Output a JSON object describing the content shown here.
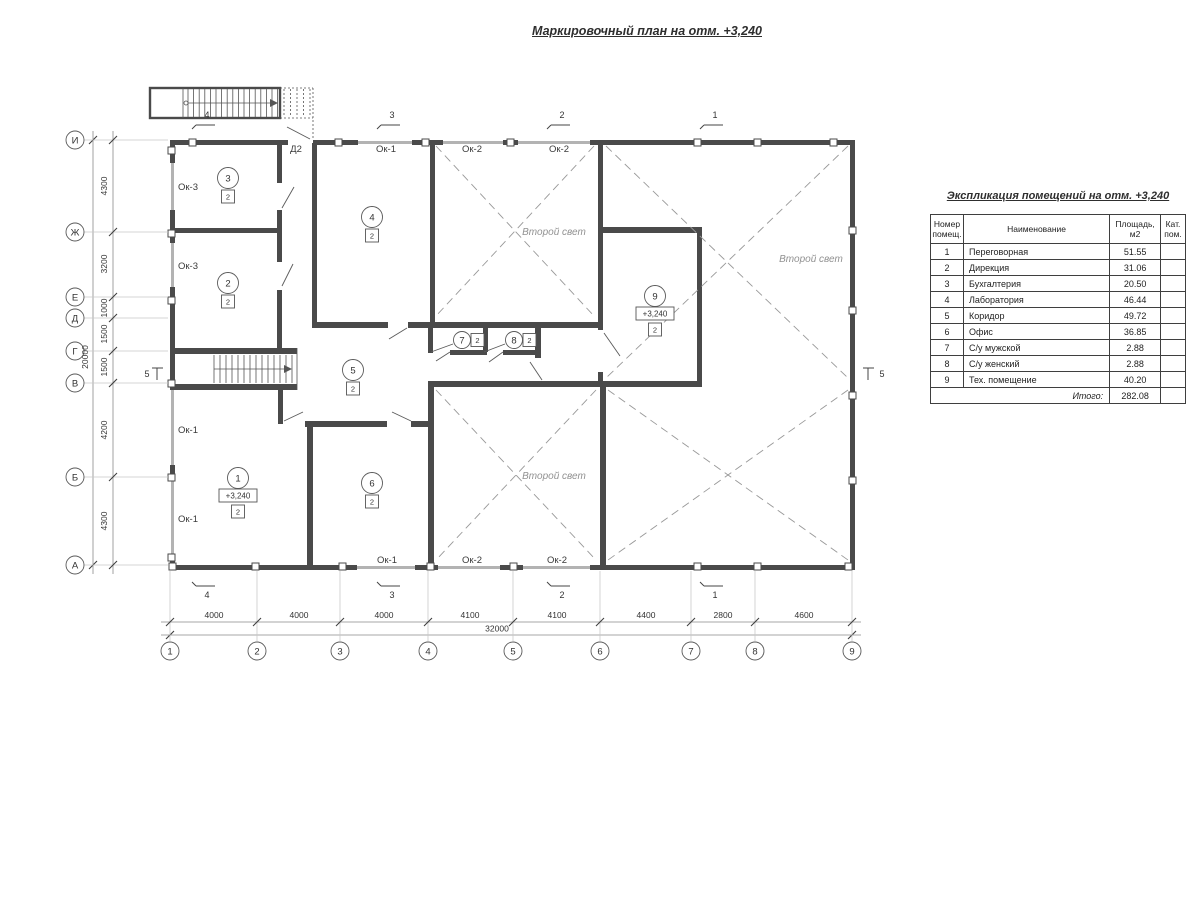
{
  "page_title": "Маркировочный план на отм. +3,240",
  "plan": {
    "elevation_mark": "+3,240",
    "axes_left": [
      {
        "label": "И",
        "y": 140
      },
      {
        "label": "Ж",
        "y": 232
      },
      {
        "label": "Е",
        "y": 297
      },
      {
        "label": "Д",
        "y": 318
      },
      {
        "label": "Г",
        "y": 351
      },
      {
        "label": "В",
        "y": 383
      },
      {
        "label": "Б",
        "y": 477
      },
      {
        "label": "А",
        "y": 565
      }
    ],
    "axes_bottom": [
      {
        "label": "1",
        "x": 170
      },
      {
        "label": "2",
        "x": 257
      },
      {
        "label": "3",
        "x": 340
      },
      {
        "label": "4",
        "x": 428
      },
      {
        "label": "5",
        "x": 513
      },
      {
        "label": "6",
        "x": 600
      },
      {
        "label": "7",
        "x": 691
      },
      {
        "label": "8",
        "x": 755
      },
      {
        "label": "9",
        "x": 852
      }
    ],
    "dims_left": [
      {
        "text": "4300",
        "y": 186
      },
      {
        "text": "3200",
        "y": 264
      },
      {
        "text": "1000",
        "y": 308
      },
      {
        "text": "1500",
        "y": 334
      },
      {
        "text": "1500",
        "y": 367
      },
      {
        "text": "4200",
        "y": 430
      },
      {
        "text": "4300",
        "y": 521
      }
    ],
    "dim_left_total": "20000",
    "dims_bottom": [
      {
        "text": "4000",
        "x": 214
      },
      {
        "text": "4000",
        "x": 299
      },
      {
        "text": "4000",
        "x": 384
      },
      {
        "text": "4100",
        "x": 470
      },
      {
        "text": "4100",
        "x": 557
      },
      {
        "text": "4400",
        "x": 646
      },
      {
        "text": "2800",
        "x": 723
      },
      {
        "text": "4600",
        "x": 804
      }
    ],
    "dim_bottom_total": "32000",
    "rooms": [
      {
        "num": "1",
        "x": 238,
        "y": 478,
        "elev": "+3,240",
        "cat": "2"
      },
      {
        "num": "2",
        "x": 228,
        "y": 283,
        "cat": "2"
      },
      {
        "num": "3",
        "x": 228,
        "y": 178,
        "cat": "2"
      },
      {
        "num": "4",
        "x": 372,
        "y": 217,
        "cat": "2"
      },
      {
        "num": "5",
        "x": 353,
        "y": 370,
        "cat": "2"
      },
      {
        "num": "6",
        "x": 372,
        "y": 483,
        "cat": "2"
      },
      {
        "num": "7",
        "x": 462,
        "y": 340,
        "cat": "2",
        "cat_side": "right"
      },
      {
        "num": "8",
        "x": 514,
        "y": 340,
        "cat": "2",
        "cat_side": "right"
      },
      {
        "num": "9",
        "x": 655,
        "y": 296,
        "elev": "+3,240",
        "cat": "2"
      }
    ],
    "window_labels": [
      {
        "text": "Ок-3",
        "x": 188,
        "y": 187
      },
      {
        "text": "Ок-3",
        "x": 188,
        "y": 266
      },
      {
        "text": "Ок-1",
        "x": 188,
        "y": 430
      },
      {
        "text": "Ок-1",
        "x": 188,
        "y": 519
      },
      {
        "text": "Ок-1",
        "x": 386,
        "y": 149
      },
      {
        "text": "Ок-2",
        "x": 472,
        "y": 149
      },
      {
        "text": "Ок-2",
        "x": 559,
        "y": 149
      },
      {
        "text": "Ок-1",
        "x": 387,
        "y": 560
      },
      {
        "text": "Ок-2",
        "x": 472,
        "y": 560
      },
      {
        "text": "Ок-2",
        "x": 557,
        "y": 560
      }
    ],
    "door_labels": [
      {
        "text": "Д2",
        "x": 296,
        "y": 149
      }
    ],
    "void_labels": [
      {
        "text": "Второй свет",
        "x": 554,
        "y": 232
      },
      {
        "text": "Второй свет",
        "x": 811,
        "y": 259
      },
      {
        "text": "Второй свет",
        "x": 554,
        "y": 476
      }
    ],
    "section_markers": {
      "top": [
        {
          "text": "4",
          "x": 205
        },
        {
          "text": "3",
          "x": 390
        },
        {
          "text": "2",
          "x": 560
        },
        {
          "text": "1",
          "x": 713
        }
      ],
      "bottom": [
        {
          "text": "4",
          "x": 205
        },
        {
          "text": "3",
          "x": 390
        },
        {
          "text": "2",
          "x": 560
        },
        {
          "text": "1",
          "x": 713
        }
      ],
      "left": {
        "text": "5"
      },
      "right": {
        "text": "5"
      }
    }
  },
  "table": {
    "title": "Экспликация помещений на отм. +3,240",
    "headers": [
      "Номер помещ.",
      "Наименование",
      "Площадь, м2",
      "Кат. пом."
    ],
    "rows": [
      [
        "1",
        "Переговорная",
        "51.55",
        ""
      ],
      [
        "2",
        "Дирекция",
        "31.06",
        ""
      ],
      [
        "3",
        "Бухгалтерия",
        "20.50",
        ""
      ],
      [
        "4",
        "Лаборатория",
        "46.44",
        ""
      ],
      [
        "5",
        "Коридор",
        "49.72",
        ""
      ],
      [
        "6",
        "Офис",
        "36.85",
        ""
      ],
      [
        "7",
        "С/у мужской",
        "2.88",
        ""
      ],
      [
        "8",
        "С/у женский",
        "2.88",
        ""
      ],
      [
        "9",
        "Тех. помещение",
        "40.20",
        ""
      ]
    ],
    "total_label": "Итого:",
    "total_value": "282.08"
  }
}
